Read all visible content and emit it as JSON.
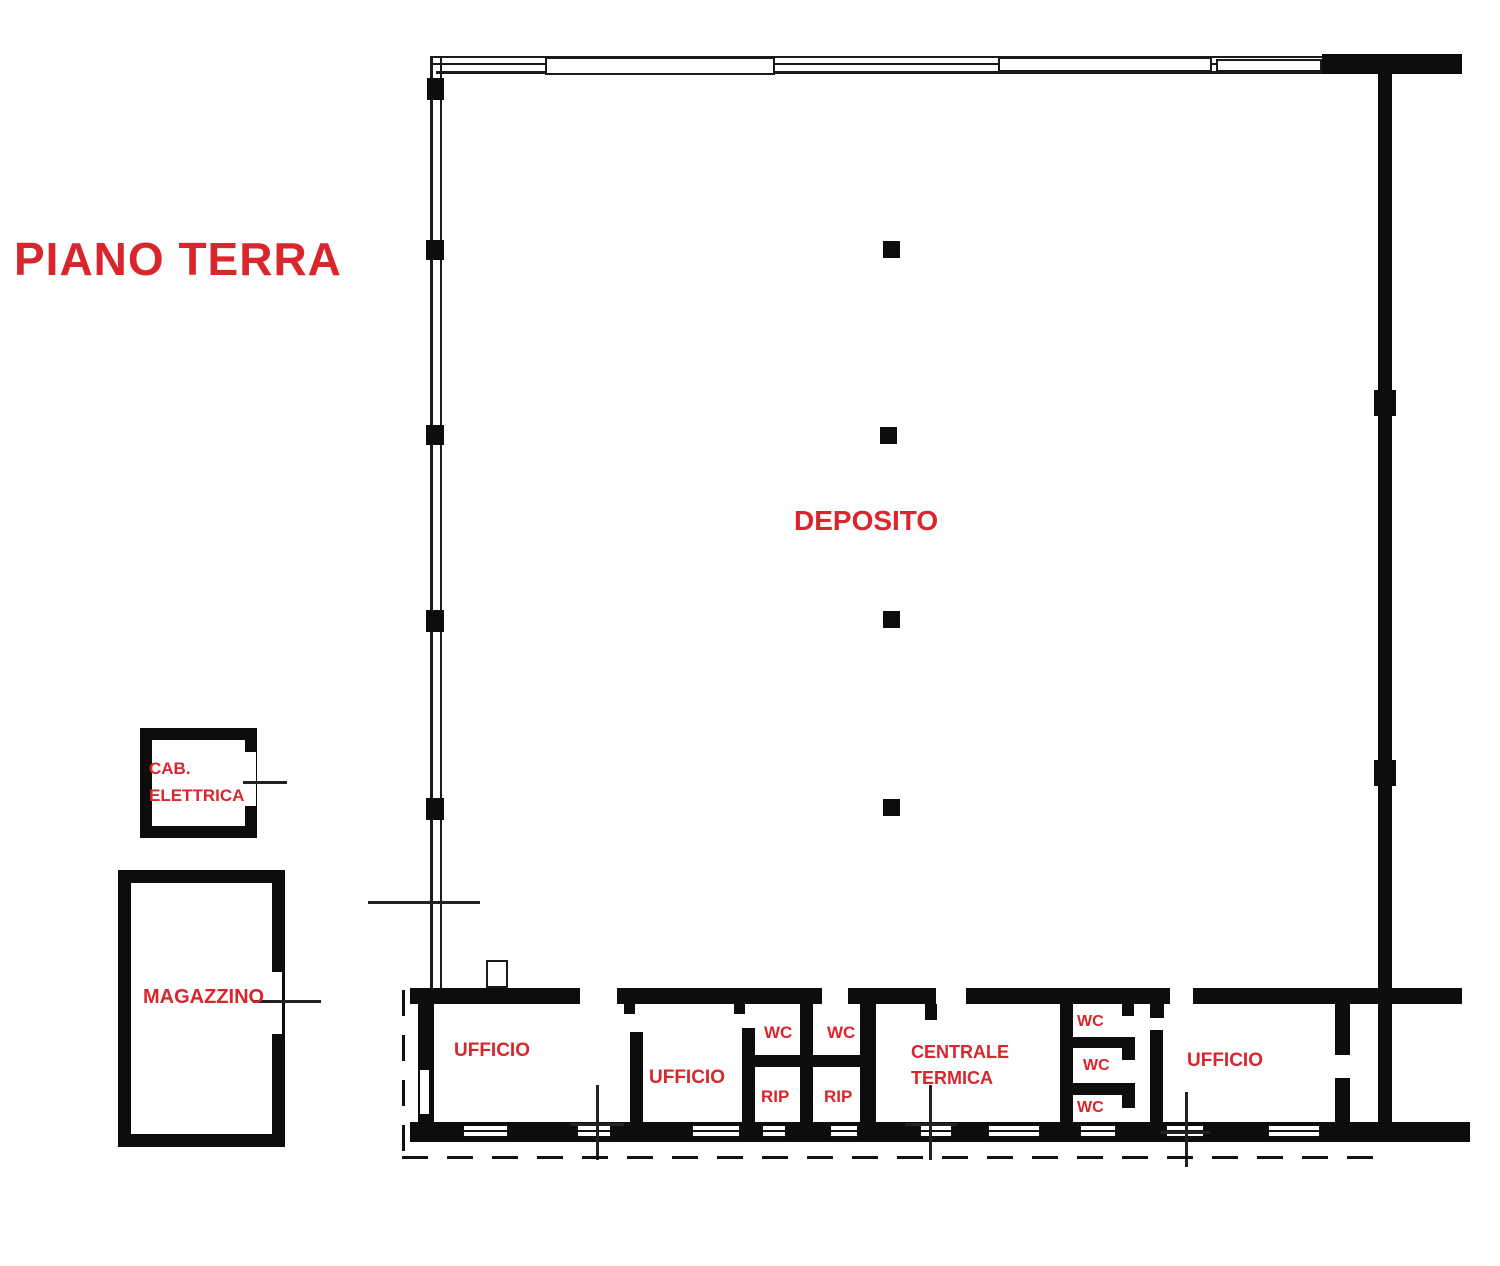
{
  "title": "PIANO TERRA",
  "colors": {
    "label_red": "#d8262c",
    "wall_black": "#0d0d0d"
  },
  "rooms": {
    "deposito": {
      "label": "DEPOSITO"
    },
    "cab_elettrica": {
      "label_line1": "CAB.",
      "label_line2": "ELETTRICA"
    },
    "magazzino": {
      "label": "MAGAZZINO"
    },
    "ufficio_left": {
      "label": "UFFICIO"
    },
    "ufficio_center": {
      "label": "UFFICIO"
    },
    "ufficio_right": {
      "label": "UFFICIO"
    },
    "wc_top_left": {
      "label": "WC"
    },
    "wc_top_right": {
      "label": "WC"
    },
    "rip_left": {
      "label": "RIP"
    },
    "rip_right": {
      "label": "RIP"
    },
    "centrale_termica": {
      "label_line1": "CENTRALE",
      "label_line2": "TERMICA"
    },
    "wc_stack_top": {
      "label": "WC"
    },
    "wc_stack_middle": {
      "label": "WC"
    },
    "wc_stack_bottom": {
      "label": "WC"
    }
  }
}
